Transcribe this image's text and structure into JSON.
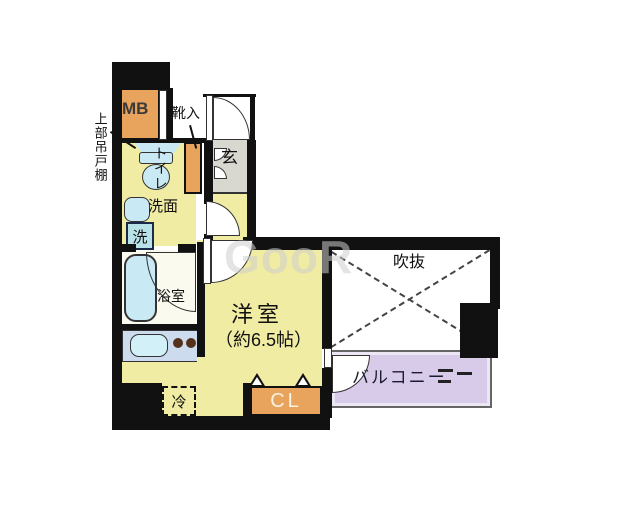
{
  "floor_plan": {
    "labels": {
      "meter_box": "MB",
      "shoe_cabinet": "靴入",
      "upper_cabinet": "上部吊戸棚",
      "toilet": "トイレ",
      "washbasin": "洗面",
      "washer": "洗",
      "bathroom": "浴室",
      "entrance": "玄",
      "room_name": "洋室",
      "room_size": "（約6.5帖）",
      "void_space": "吹抜",
      "balcony": "バルコニー",
      "closet": "CL",
      "refrigerator": "冷",
      "watermark": "GooR"
    },
    "colors": {
      "wall": "#111111",
      "room_yellow": "#f0eca3",
      "fixture_orange": "#e8a35c",
      "genkan_gray": "#d9d8d0",
      "fixture_blue": "#c9e9f4",
      "counter_blue": "#ccdcee",
      "balcony_purple": "#d8cbe9"
    }
  }
}
